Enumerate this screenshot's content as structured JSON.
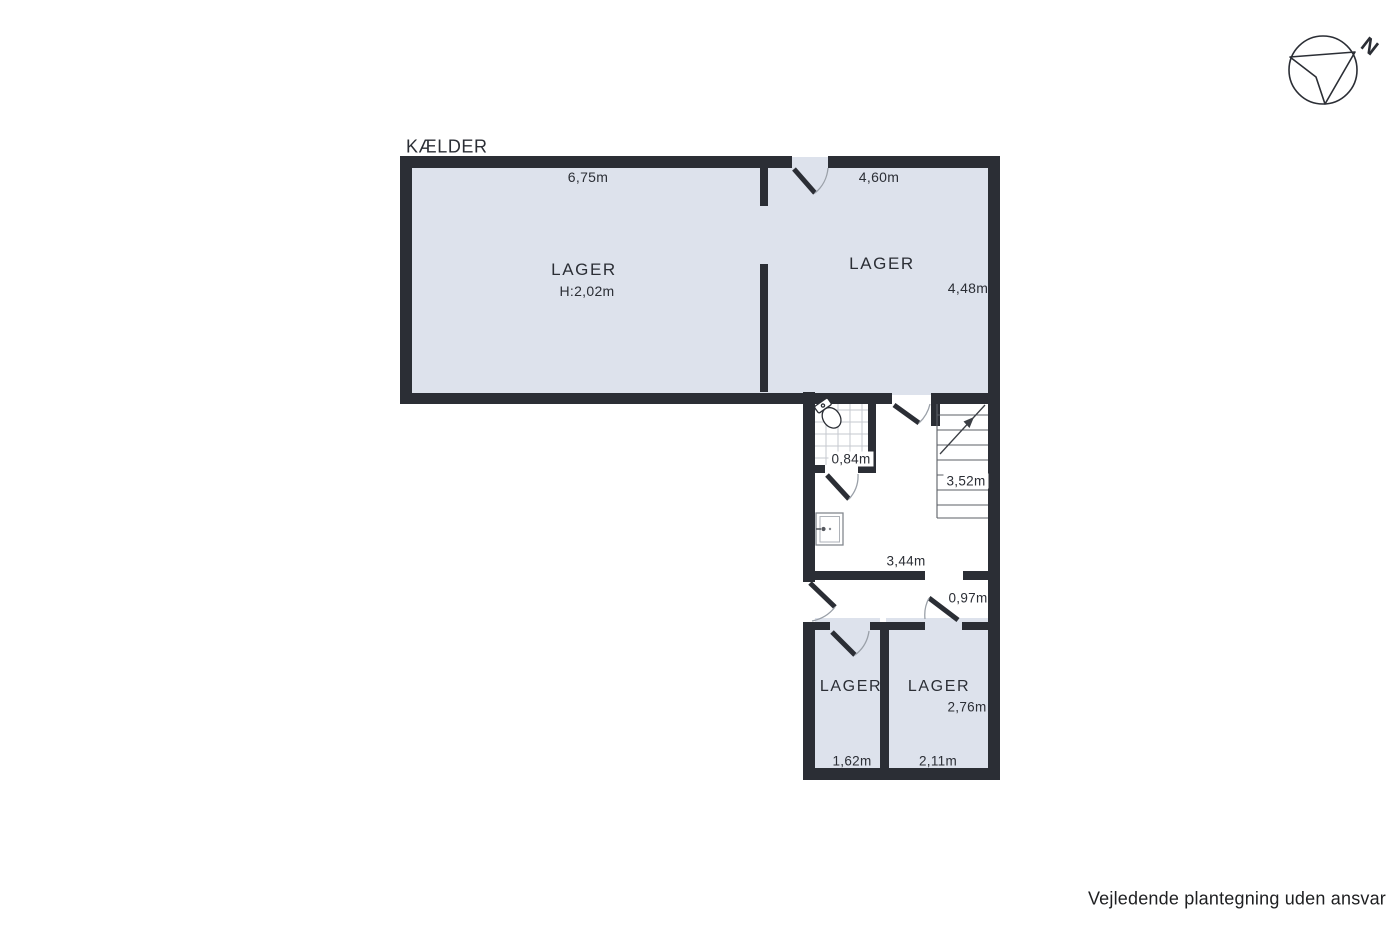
{
  "plan": {
    "title": "KÆLDER"
  },
  "rooms": {
    "large_left": {
      "name": "LAGER",
      "height_note": "H:2,02m",
      "width": "6,75m"
    },
    "large_right": {
      "name": "LAGER",
      "width": "4,60m",
      "depth": "4,48m"
    },
    "bathroom": {
      "width": "0,84m"
    },
    "stairwell": {
      "depth": "3,52m"
    },
    "hallway": {
      "width": "3,44m",
      "door": "0,97m"
    },
    "small_left": {
      "name": "LAGER",
      "width": "1,62m"
    },
    "small_right": {
      "name": "LAGER",
      "depth": "2,76m",
      "width": "2,11m"
    }
  },
  "compass": {
    "label": "N"
  },
  "footer": {
    "disclaimer": "Vejledende plantegning uden ansvar"
  },
  "colors": {
    "wall": "#2b2e35",
    "floor": "#dde2ec",
    "bg": "#ffffff",
    "tile_grid": "#c5c9cf",
    "stair_line": "#5b5f66",
    "arc": "#9aa0a8",
    "text": "#2b2e35"
  }
}
